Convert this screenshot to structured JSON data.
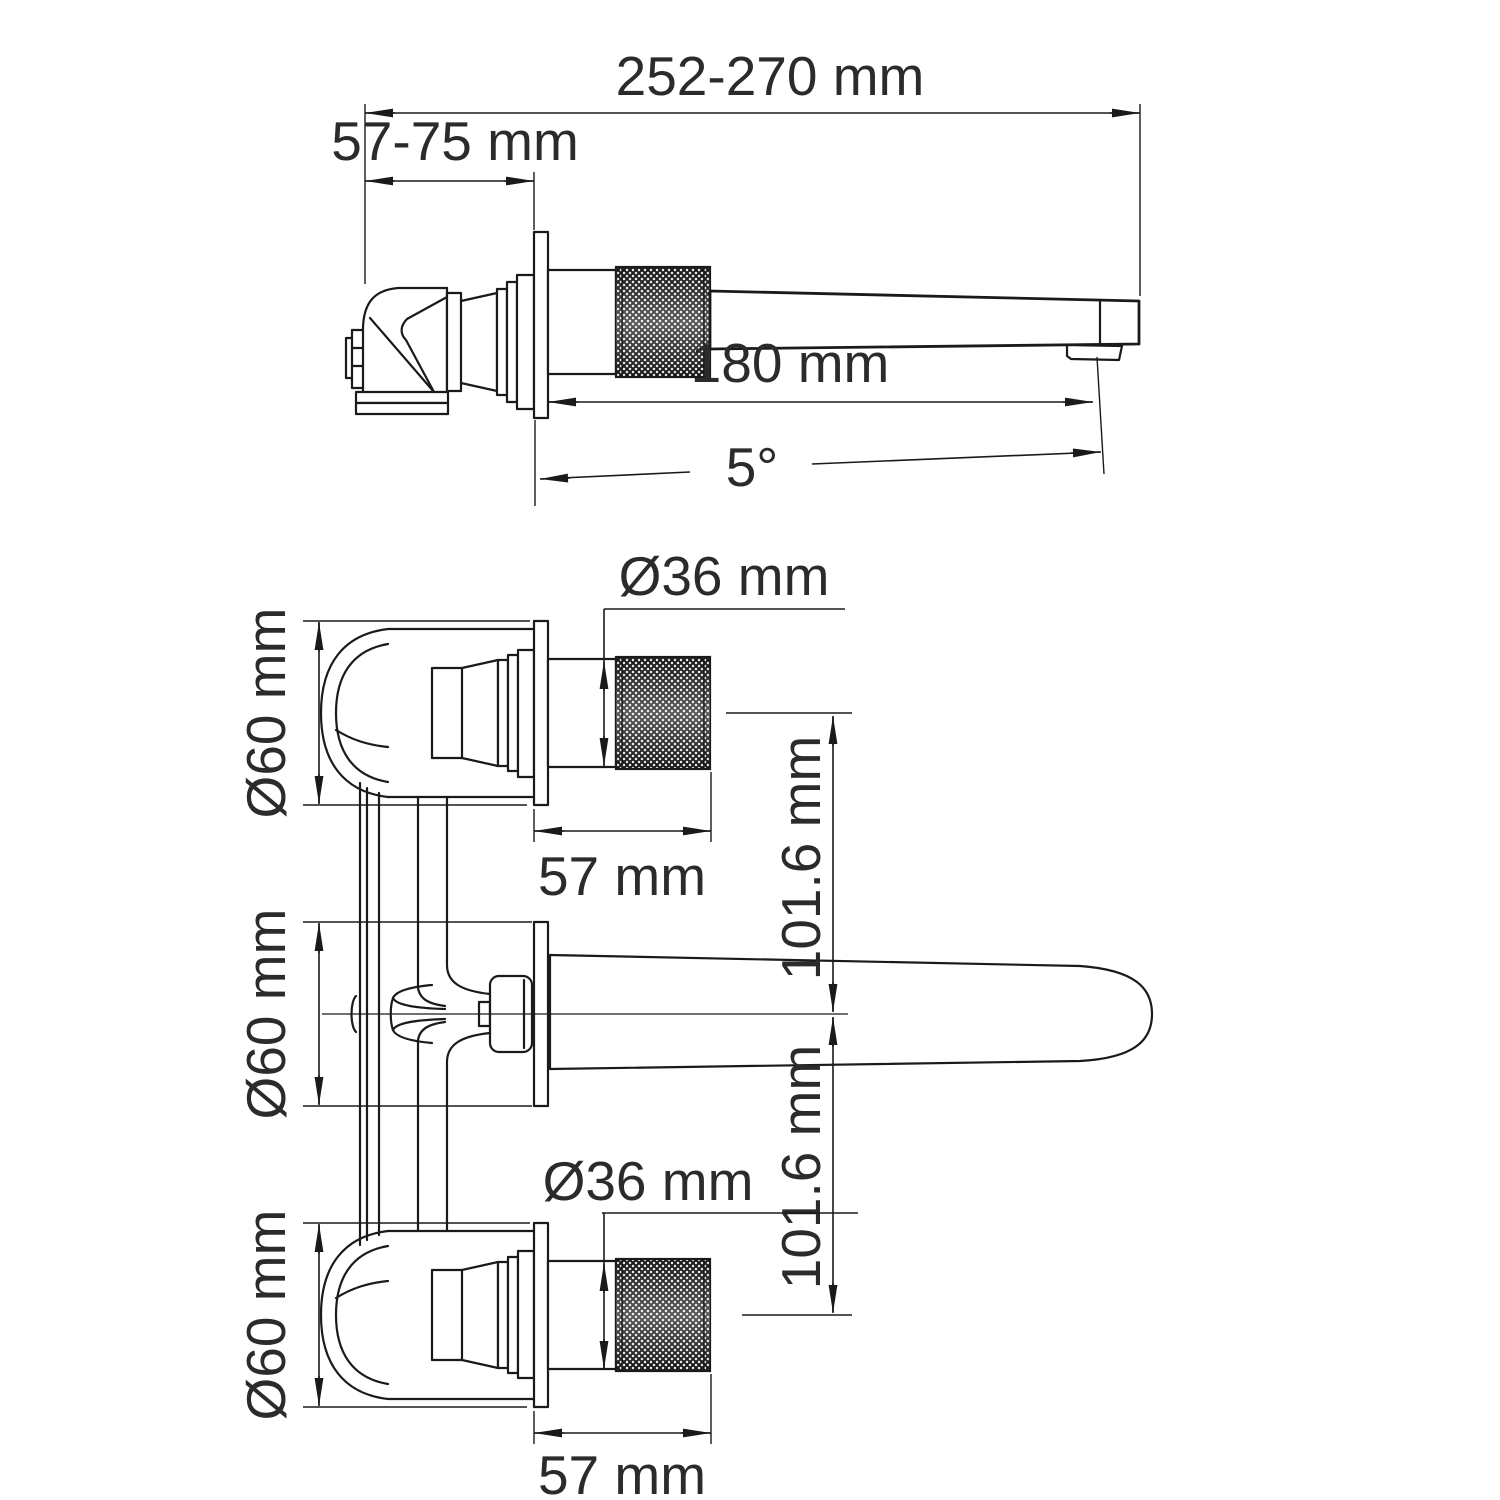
{
  "drawing": {
    "side_view": {
      "total_depth": "252-270 mm",
      "wall_depth": "57-75 mm",
      "spout_length": "180 mm",
      "spout_angle": "5°"
    },
    "front_view": {
      "handle_top": {
        "diameter": "Ø36 mm",
        "length": "57 mm",
        "plate_diameter": "Ø60 mm"
      },
      "spout": {
        "plate_diameter": "Ø60 mm"
      },
      "handle_bottom": {
        "diameter": "Ø36 mm",
        "length": "57 mm",
        "plate_diameter": "Ø60 mm"
      },
      "spacing_top": "101.6 mm",
      "spacing_bottom": "101.6 mm"
    },
    "colors": {
      "line": "#1a1a1a",
      "background": "#ffffff"
    }
  }
}
